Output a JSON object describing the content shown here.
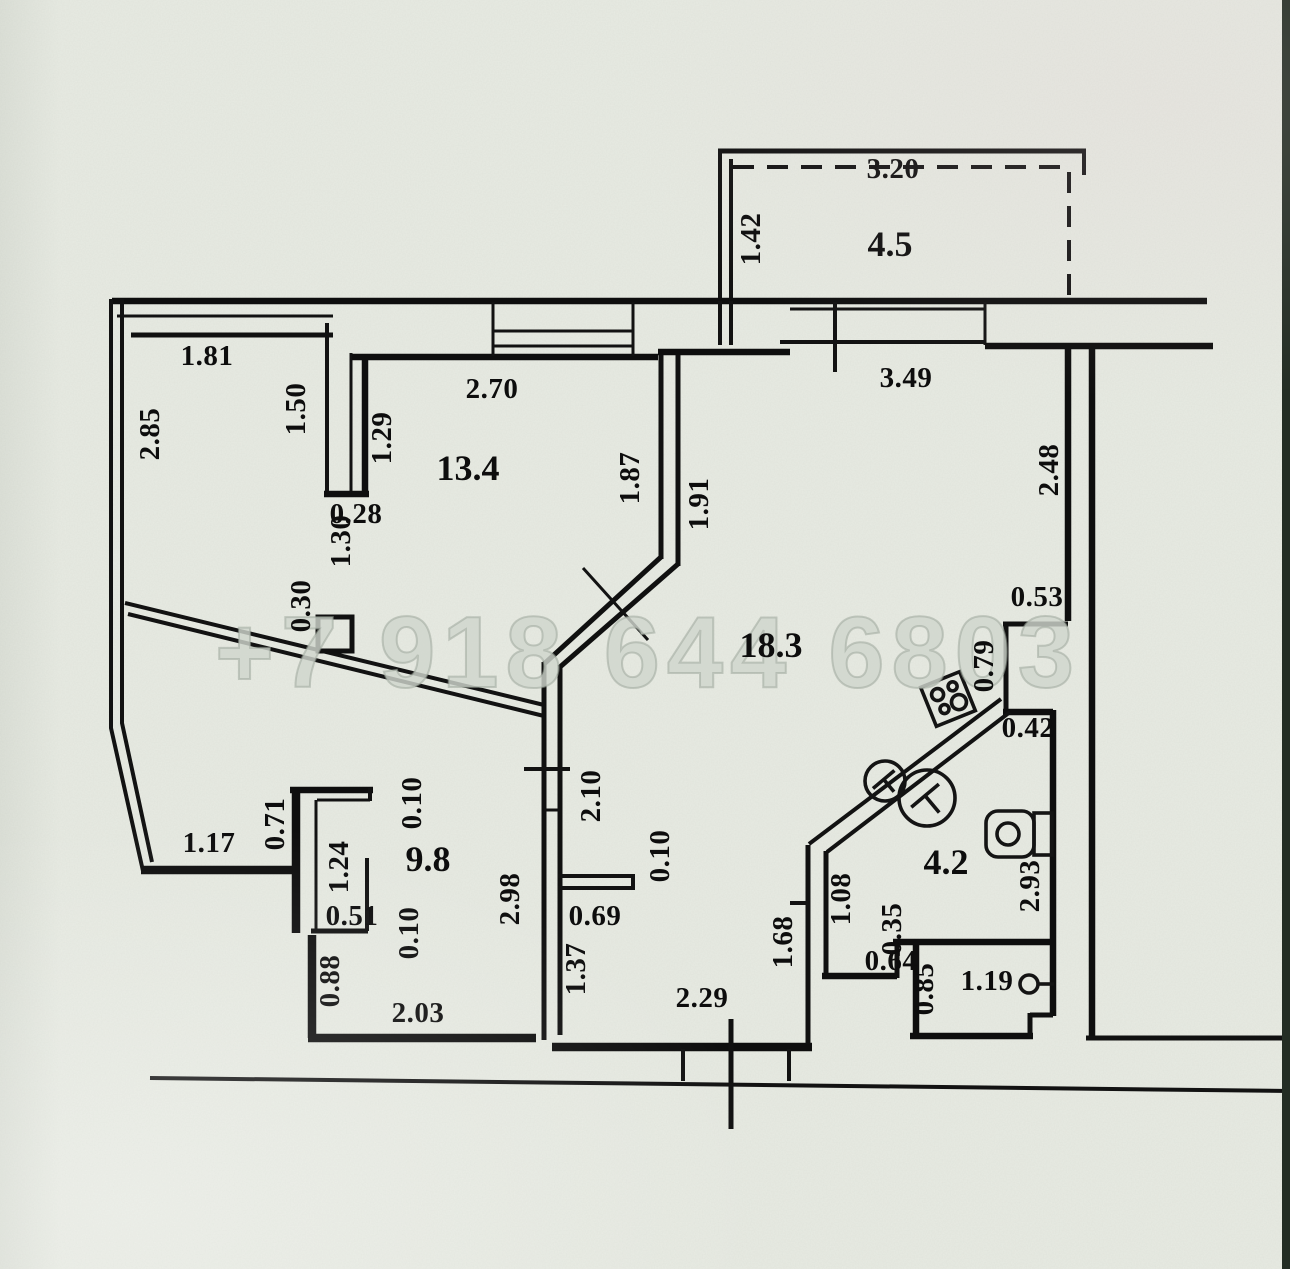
{
  "watermark": {
    "text": "+7 918 644 6803"
  },
  "colors": {
    "paper": "#e8ebe3",
    "ink": "#0e0e0e",
    "watermark": "#d0d6cd",
    "edge_strip": "#232d24"
  },
  "plan": {
    "units": "m",
    "rooms": [
      {
        "label": "4.5",
        "x": 890,
        "y": 244
      },
      {
        "label": "13.4",
        "x": 468,
        "y": 468
      },
      {
        "label": "18.3",
        "x": 771,
        "y": 645
      },
      {
        "label": "9.8",
        "x": 428,
        "y": 859
      },
      {
        "label": "4.2",
        "x": 946,
        "y": 862
      }
    ],
    "dimensions": [
      {
        "text": "3.20",
        "x": 893,
        "y": 169,
        "rot": 0
      },
      {
        "text": "1.42",
        "x": 751,
        "y": 239,
        "rot": -90
      },
      {
        "text": "1.81",
        "x": 207,
        "y": 356,
        "rot": 0
      },
      {
        "text": "2.85",
        "x": 150,
        "y": 434,
        "rot": -90
      },
      {
        "text": "1.50",
        "x": 296,
        "y": 409,
        "rot": -90
      },
      {
        "text": "1.29",
        "x": 382,
        "y": 438,
        "rot": -90
      },
      {
        "text": "2.70",
        "x": 492,
        "y": 389,
        "rot": 0
      },
      {
        "text": "0.28",
        "x": 356,
        "y": 514,
        "rot": 0
      },
      {
        "text": "1.30",
        "x": 341,
        "y": 541,
        "rot": -90
      },
      {
        "text": "0.30",
        "x": 301,
        "y": 606,
        "rot": -90
      },
      {
        "text": "1.87",
        "x": 630,
        "y": 478,
        "rot": -90
      },
      {
        "text": "1.91",
        "x": 699,
        "y": 504,
        "rot": -90
      },
      {
        "text": "3.49",
        "x": 906,
        "y": 378,
        "rot": 0
      },
      {
        "text": "2.48",
        "x": 1049,
        "y": 470,
        "rot": -90
      },
      {
        "text": "0.53",
        "x": 1037,
        "y": 597,
        "rot": 0
      },
      {
        "text": "0.79",
        "x": 984,
        "y": 666,
        "rot": -90
      },
      {
        "text": "0.42",
        "x": 1028,
        "y": 728,
        "rot": 0
      },
      {
        "text": "2.10",
        "x": 591,
        "y": 796,
        "rot": -90
      },
      {
        "text": "0.10",
        "x": 412,
        "y": 803,
        "rot": -90
      },
      {
        "text": "1.24",
        "x": 339,
        "y": 867,
        "rot": -90
      },
      {
        "text": "1.17",
        "x": 209,
        "y": 843,
        "rot": 0
      },
      {
        "text": "0.71",
        "x": 275,
        "y": 824,
        "rot": -90
      },
      {
        "text": "0.51",
        "x": 352,
        "y": 916,
        "rot": 0
      },
      {
        "text": "0.10",
        "x": 409,
        "y": 933,
        "rot": -90
      },
      {
        "text": "0.88",
        "x": 330,
        "y": 981,
        "rot": -90
      },
      {
        "text": "2.03",
        "x": 418,
        "y": 1013,
        "rot": 0
      },
      {
        "text": "2.98",
        "x": 510,
        "y": 899,
        "rot": -90
      },
      {
        "text": "0.69",
        "x": 595,
        "y": 916,
        "rot": 0
      },
      {
        "text": "1.37",
        "x": 576,
        "y": 969,
        "rot": -90
      },
      {
        "text": "0.10",
        "x": 660,
        "y": 856,
        "rot": -90
      },
      {
        "text": "2.29",
        "x": 702,
        "y": 998,
        "rot": 0
      },
      {
        "text": "1.68",
        "x": 783,
        "y": 942,
        "rot": -90
      },
      {
        "text": "1.08",
        "x": 841,
        "y": 899,
        "rot": -90
      },
      {
        "text": "0.64",
        "x": 891,
        "y": 961,
        "rot": 0
      },
      {
        "text": "0.35",
        "x": 892,
        "y": 929,
        "rot": -90
      },
      {
        "text": "0.85",
        "x": 924,
        "y": 989,
        "rot": -90
      },
      {
        "text": "2.93",
        "x": 1030,
        "y": 886,
        "rot": -90
      },
      {
        "text": "1.19",
        "x": 987,
        "y": 981,
        "rot": 0
      }
    ]
  }
}
